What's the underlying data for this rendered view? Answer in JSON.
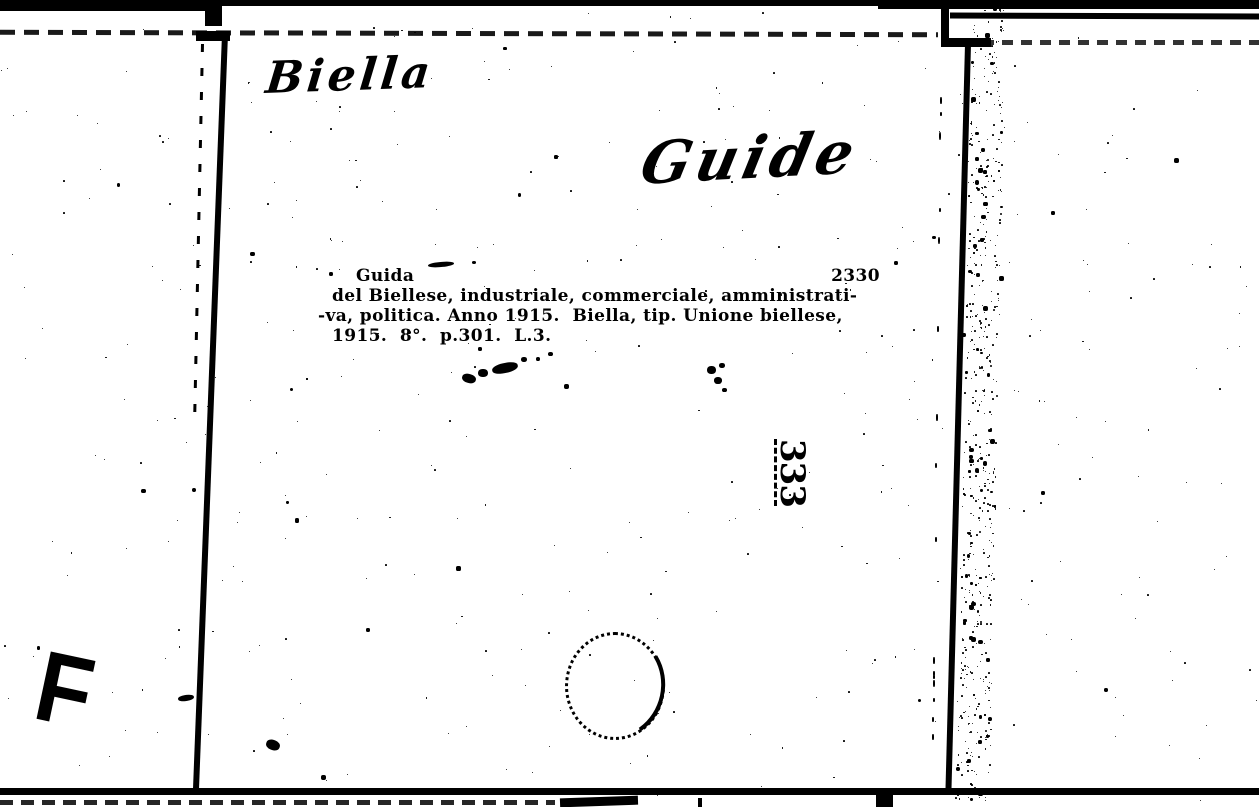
{
  "page": {
    "kind": "scanned library catalog card",
    "colors": {
      "paper": "#ffffff",
      "ink": "#000000"
    }
  },
  "card": {
    "handwritten_annotations": [
      {
        "name": "place",
        "text": "Biella"
      },
      {
        "name": "heading",
        "text": "Guide"
      }
    ],
    "printed_entry": {
      "title": "Guida",
      "entry_number": "2330",
      "lines": [
        "del Biellese, industriale, commerciale, amministrati-",
        "-va, politica. Anno 1915.  Biella, tip. Unione biellese,",
        "1915.  8°.  p.301.  L.3."
      ]
    },
    "stamped_vertical_number": "333",
    "corner_letter": "F"
  }
}
